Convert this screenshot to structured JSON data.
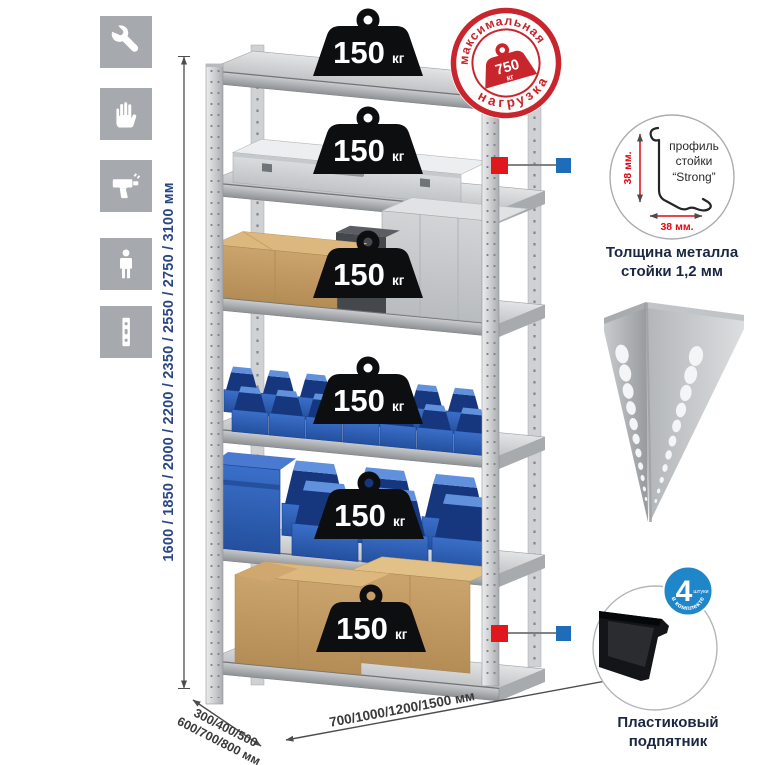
{
  "window": {
    "width": 765,
    "height": 765,
    "background": "#ffffff"
  },
  "feature_icons": [
    "wrench",
    "gloves",
    "drill",
    "person",
    "rack-post"
  ],
  "rack": {
    "shelf_count": 6,
    "shelf_load_value": "150",
    "shelf_load_unit": "кг"
  },
  "max_load_stamp": {
    "arc_top": "максимальная",
    "arc_bottom": "нагрузка",
    "value": "750",
    "unit": "кг"
  },
  "dimensions": {
    "height": "1600 / 1850 / 2000 / 2200 / 2350 / 2550 / 2750 / 3100 мм",
    "depth": "300/400/500\n600/700/800 мм",
    "width": "700/1000/1200/1500 мм"
  },
  "profile_detail": {
    "label_line1": "профиль",
    "label_line2": "стойки",
    "label_line3": "“Strong”",
    "dim_vertical": "38 мм.",
    "dim_horizontal": "38 мм.",
    "caption": "Толщина металла\nстойки 1,2 мм"
  },
  "foot_detail": {
    "badge_value": "4",
    "badge_qualifier": "штуки",
    "badge_arc": "в комплекте",
    "caption": "Пластиковый\nподпятник"
  },
  "colors": {
    "stamp_red": "#c8262c",
    "marker_red": "#e1171e",
    "marker_blue": "#1f6cba",
    "bin_blue": "#2f64bd",
    "dim_navy": "#2a4683",
    "icon_gray": "#a6a9ad"
  }
}
